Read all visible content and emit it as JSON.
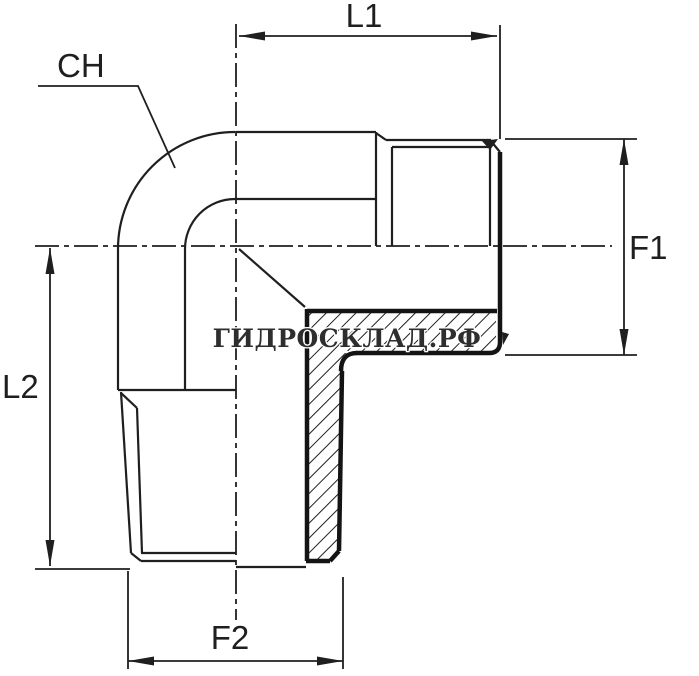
{
  "drawing": {
    "type": "technical-drawing",
    "subject": "90-degree elbow fitting, male x male, half-section view",
    "watermark": "ГИДРОСКЛАД.РФ",
    "labels": {
      "l1": "L1",
      "f1": "F1",
      "l2": "L2",
      "f2": "F2",
      "ch": "CH"
    }
  },
  "colors": {
    "background": "#ffffff",
    "line": "#1f1f1f",
    "bold_line": "#141414",
    "watermark_fill": "#2e2e2e",
    "watermark_halo": "#ffffff"
  }
}
